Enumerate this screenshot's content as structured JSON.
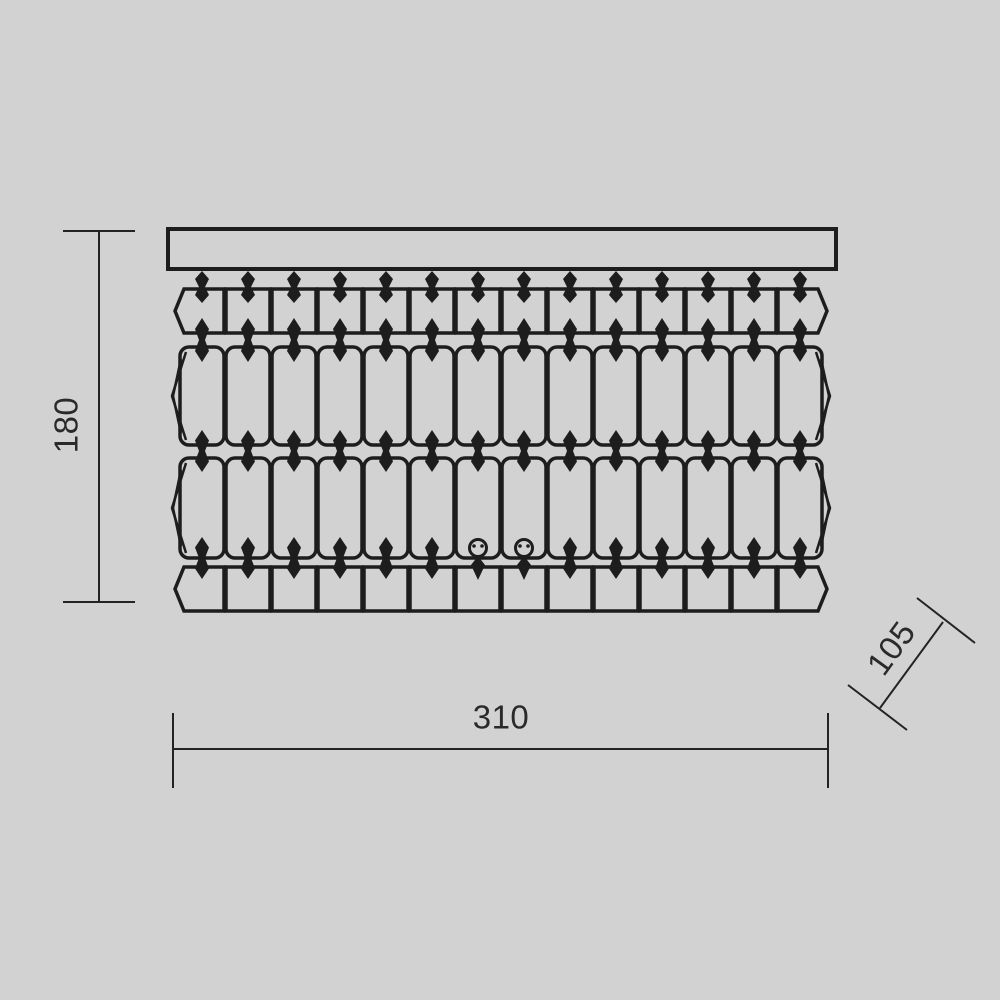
{
  "background_color": "#d2d2d2",
  "line_color": "#1d1d1d",
  "text_color": "#2a2a2a",
  "drawing": {
    "type": "technical-dimension-drawing",
    "subject": "crystal ceiling chandelier, front elevation",
    "dimensions": {
      "height": {
        "label": "180"
      },
      "width": {
        "label": "310"
      },
      "depth": {
        "label": "105"
      }
    },
    "fixture": {
      "bar": {
        "x": 168,
        "y": 229,
        "width": 668,
        "height": 40
      },
      "columns": 14,
      "column_start_x": 202,
      "column_spacing": 46,
      "crystal_width": 44,
      "rows": [
        {
          "top": 289,
          "height": 44,
          "corner": "sharp"
        },
        {
          "top": 347,
          "height": 98,
          "corner": "rounded"
        },
        {
          "top": 458,
          "height": 100,
          "corner": "rounded"
        },
        {
          "top": 567,
          "height": 44,
          "corner": "sharp"
        }
      ],
      "bead_rows": [
        {
          "cy": 287,
          "h": 32
        },
        {
          "cy": 340,
          "h": 44
        },
        {
          "cy": 451,
          "h": 42
        },
        {
          "cy": 558,
          "h": 42,
          "ring_columns": [
            6,
            7
          ]
        }
      ]
    }
  }
}
